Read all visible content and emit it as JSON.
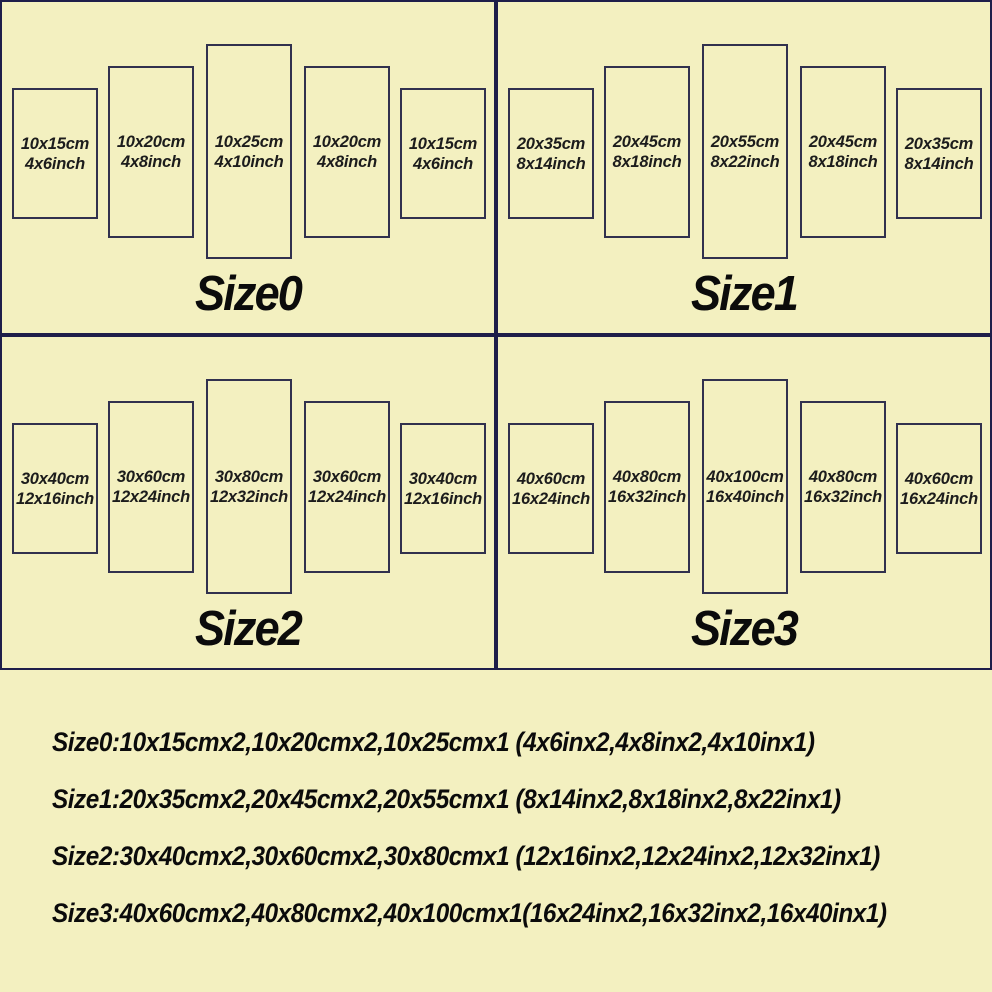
{
  "colors": {
    "background": "#f3f0c0",
    "border": "#1e1e4a",
    "panel_border": "#31314e",
    "text": "#1c1c1c",
    "heading": "#0b0b0b"
  },
  "quadrants": [
    {
      "title": "Size0",
      "panels": [
        {
          "cm": "10x15cm",
          "inch": "4x6inch"
        },
        {
          "cm": "10x20cm",
          "inch": "4x8inch"
        },
        {
          "cm": "10x25cm",
          "inch": "4x10inch"
        },
        {
          "cm": "10x20cm",
          "inch": "4x8inch"
        },
        {
          "cm": "10x15cm",
          "inch": "4x6inch"
        }
      ]
    },
    {
      "title": "Size1",
      "panels": [
        {
          "cm": "20x35cm",
          "inch": "8x14inch"
        },
        {
          "cm": "20x45cm",
          "inch": "8x18inch"
        },
        {
          "cm": "20x55cm",
          "inch": "8x22inch"
        },
        {
          "cm": "20x45cm",
          "inch": "8x18inch"
        },
        {
          "cm": "20x35cm",
          "inch": "8x14inch"
        }
      ]
    },
    {
      "title": "Size2",
      "panels": [
        {
          "cm": "30x40cm",
          "inch": "12x16inch"
        },
        {
          "cm": "30x60cm",
          "inch": "12x24inch"
        },
        {
          "cm": "30x80cm",
          "inch": "12x32inch"
        },
        {
          "cm": "30x60cm",
          "inch": "12x24inch"
        },
        {
          "cm": "30x40cm",
          "inch": "12x16inch"
        }
      ]
    },
    {
      "title": "Size3",
      "panels": [
        {
          "cm": "40x60cm",
          "inch": "16x24inch"
        },
        {
          "cm": "40x80cm",
          "inch": "16x32inch"
        },
        {
          "cm": "40x100cm",
          "inch": "16x40inch"
        },
        {
          "cm": "40x80cm",
          "inch": "16x32inch"
        },
        {
          "cm": "40x60cm",
          "inch": "16x24inch"
        }
      ]
    }
  ],
  "summary": [
    "Size0:10x15cmx2,10x20cmx2,10x25cmx1 (4x6inx2,4x8inx2,4x10inx1)",
    "Size1:20x35cmx2,20x45cmx2,20x55cmx1 (8x14inx2,8x18inx2,8x22inx1)",
    "Size2:30x40cmx2,30x60cmx2,30x80cmx1 (12x16inx2,12x24inx2,12x32inx1)",
    "Size3:40x60cmx2,40x80cmx2,40x100cmx1(16x24inx2,16x32inx2,16x40inx1)"
  ]
}
